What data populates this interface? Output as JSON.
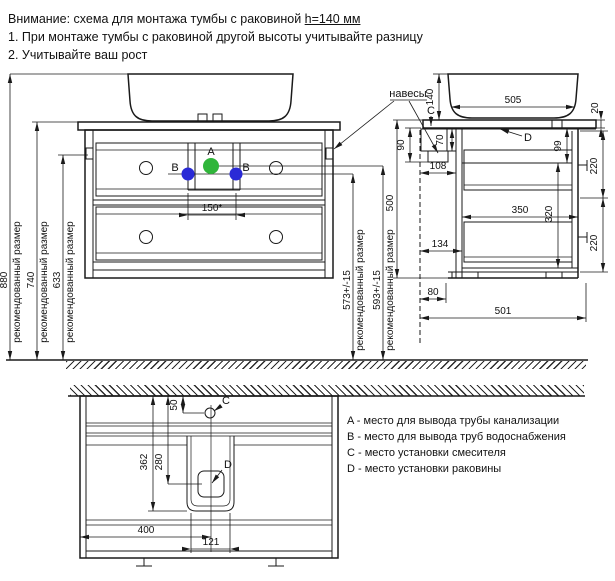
{
  "header": {
    "line1_prefix": "Внимание: схема для монтажа тумбы с раковиной ",
    "line1_underlined": "h=140 мм",
    "line2": "1. При монтаже тумбы с раковиной другой высоты учитывайте разницу",
    "line3": "2. Учитывайте ваш рост"
  },
  "shared": {
    "recommended_label": "рекомендованный размер",
    "hinges_label": "навесы"
  },
  "points": {
    "a": "A",
    "b": "B",
    "c": "C",
    "d": "D"
  },
  "front_view": {
    "dims": {
      "d880": "880",
      "d740": "740",
      "d633": "633",
      "d150": "150*",
      "d573": "573+/-15",
      "d593": "593+/-15"
    }
  },
  "side_view": {
    "dims": {
      "d505": "505",
      "d140": "140",
      "d20": "20",
      "d90": "90",
      "d70": "70",
      "d108": "108",
      "d99": "99",
      "d220a": "220",
      "d220b": "220",
      "d320": "320",
      "d350": "350",
      "d134": "134",
      "d80": "80",
      "d501": "501",
      "d500": "500"
    }
  },
  "plan_view": {
    "dims": {
      "d50": "50",
      "d362": "362",
      "d280": "280",
      "d400": "400",
      "d121": "121"
    }
  },
  "legend": {
    "items": [
      {
        "label": "A - место для вывода трубы канализации"
      },
      {
        "label": "B - место для вывода труб водоснабжения"
      },
      {
        "label": "C - место установки смесителя"
      },
      {
        "label": "D - место установки раковины"
      }
    ]
  },
  "colors": {
    "drain_point": "#2fb53a",
    "water_point": "#2a2ad6"
  }
}
